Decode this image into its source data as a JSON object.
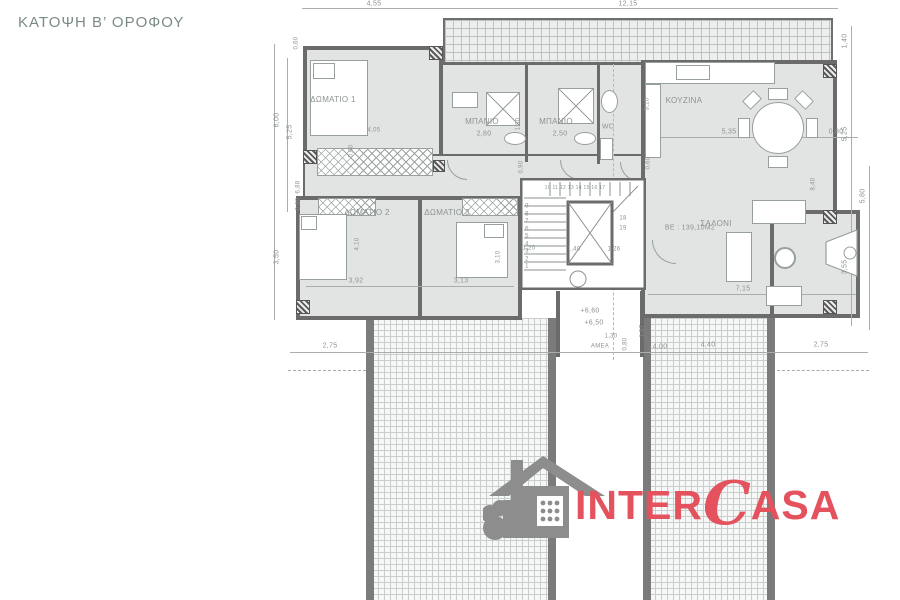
{
  "title": "ΚΑΤΟΨΗ Β’ ΟΡΟΦΟΥ",
  "logo": {
    "inter": "INTER",
    "c": "C",
    "asa": "ASA",
    "accent_color": "#e4525e",
    "house_color": "#8d8d8d"
  },
  "colors": {
    "wall": "#6b6b6b",
    "room_fill": "#e2e4e3",
    "dimension_text": "#8b9390",
    "title_text": "#7b8a84"
  },
  "plan": {
    "labels": [
      {
        "n": "room-label-bedroom1",
        "t": "ΔΩΜΑΤΙΟ 1",
        "x": 333,
        "y": 100,
        "s": 8
      },
      {
        "n": "room-label-bath1",
        "t": "ΜΠΑΝΙΟ",
        "x": 482,
        "y": 122,
        "s": 8
      },
      {
        "n": "room-label-bath2",
        "t": "ΜΠΑΝΙΟ",
        "x": 556,
        "y": 122,
        "s": 8
      },
      {
        "n": "room-label-wc",
        "t": "WC",
        "x": 608,
        "y": 128,
        "s": 7
      },
      {
        "n": "room-label-kitchen",
        "t": "ΚΟΥΖΙΝΑ",
        "x": 684,
        "y": 101,
        "s": 8
      },
      {
        "n": "room-label-living",
        "t": "ΣΑΛΟΝΙ",
        "x": 716,
        "y": 224,
        "s": 8
      },
      {
        "n": "room-label-bedroom2",
        "t": "ΔΩΜΑΤΙΟ 2",
        "x": 367,
        "y": 213,
        "s": 8
      },
      {
        "n": "room-label-bedroom3",
        "t": "ΔΩΜΑΤΙΟ 3",
        "x": 447,
        "y": 213,
        "s": 8
      },
      {
        "n": "area-label",
        "t": "ΒΕ : 139,10Μ2",
        "x": 690,
        "y": 229,
        "s": 7
      },
      {
        "n": "amea-label",
        "t": "ΑΜΕΑ",
        "x": 600,
        "y": 347,
        "s": 6
      },
      {
        "n": "dim-top-left",
        "t": "4,55",
        "x": 374,
        "y": 5,
        "s": 7
      },
      {
        "n": "dim-top-right",
        "t": "12,15",
        "x": 628,
        "y": 5,
        "s": 7
      },
      {
        "n": "dim-right-140",
        "t": "1,40",
        "x": 846,
        "y": 41,
        "s": 7,
        "r": -90
      },
      {
        "n": "dim-right-525",
        "t": "5,25",
        "x": 846,
        "y": 134,
        "s": 7,
        "r": -90
      },
      {
        "n": "dim-right-580",
        "t": "5,80",
        "x": 864,
        "y": 196,
        "s": 7,
        "r": -90
      },
      {
        "n": "dim-right-355",
        "t": "3,55",
        "x": 846,
        "y": 267,
        "s": 7,
        "r": -90
      },
      {
        "n": "dim-left-060",
        "t": "0,60",
        "x": 297,
        "y": 43,
        "s": 6,
        "r": -90
      },
      {
        "n": "dim-left-600",
        "t": "6,00",
        "x": 278,
        "y": 120,
        "s": 7,
        "r": -90
      },
      {
        "n": "dim-left-525",
        "t": "5,25",
        "x": 291,
        "y": 132,
        "s": 7,
        "r": -90
      },
      {
        "n": "dim-left-688",
        "t": "6,88",
        "x": 299,
        "y": 187,
        "s": 6,
        "r": -90
      },
      {
        "n": "dim-left-080",
        "t": "0,80",
        "x": 299,
        "y": 204,
        "s": 6,
        "r": -90
      },
      {
        "n": "dim-left-350",
        "t": "3,50",
        "x": 278,
        "y": 257,
        "s": 7,
        "r": -90
      },
      {
        "n": "dim-bottom-275-left",
        "t": "2,75",
        "x": 330,
        "y": 347,
        "s": 7
      },
      {
        "n": "dim-bottom-130",
        "t": "1,30",
        "x": 611,
        "y": 337,
        "s": 6
      },
      {
        "n": "dim-bottom-400",
        "t": "4,00",
        "x": 660,
        "y": 348,
        "s": 7
      },
      {
        "n": "dim-bottom-440",
        "t": "4,40",
        "x": 708,
        "y": 346,
        "s": 7
      },
      {
        "n": "dim-bottom-275-right",
        "t": "2,75",
        "x": 821,
        "y": 346,
        "s": 7
      },
      {
        "n": "dim-bedroom1-405",
        "t": "4,05",
        "x": 374,
        "y": 131,
        "s": 6
      },
      {
        "n": "dim-bath1-280",
        "t": "2,80",
        "x": 484,
        "y": 135,
        "s": 7
      },
      {
        "n": "dim-bath2-250",
        "t": "2,50",
        "x": 560,
        "y": 135,
        "s": 7
      },
      {
        "n": "dim-bath-180",
        "t": "1,80",
        "x": 519,
        "y": 124,
        "s": 6,
        "r": -90
      },
      {
        "n": "dim-bath-090",
        "t": "0,90",
        "x": 522,
        "y": 167,
        "s": 6,
        "r": -90
      },
      {
        "n": "dim-ward-060",
        "t": "0,60",
        "x": 352,
        "y": 151,
        "s": 6,
        "r": -90
      },
      {
        "n": "dim-kitchen-310",
        "t": "3,10",
        "x": 648,
        "y": 104,
        "s": 6,
        "r": -90
      },
      {
        "n": "dim-kitchen-060",
        "t": "0,60",
        "x": 649,
        "y": 163,
        "s": 6,
        "r": -90
      },
      {
        "n": "dim-living-535",
        "t": "5,35",
        "x": 729,
        "y": 133,
        "s": 7
      },
      {
        "n": "dim-living-080",
        "t": "0,80",
        "x": 836,
        "y": 133,
        "s": 7
      },
      {
        "n": "dim-living-840",
        "t": "8,40",
        "x": 814,
        "y": 184,
        "s": 6,
        "r": -90
      },
      {
        "n": "dim-living-715",
        "t": "7,15",
        "x": 743,
        "y": 290,
        "s": 7
      },
      {
        "n": "dim-bedroom2-392",
        "t": "3,92",
        "x": 356,
        "y": 282,
        "s": 7
      },
      {
        "n": "dim-bedroom2-410",
        "t": "4,10",
        "x": 358,
        "y": 244,
        "s": 6,
        "r": -90
      },
      {
        "n": "dim-bedroom3-313",
        "t": "3,13",
        "x": 461,
        "y": 282,
        "s": 7
      },
      {
        "n": "dim-bedroom3-310",
        "t": "3,10",
        "x": 499,
        "y": 257,
        "s": 6,
        "r": -90
      },
      {
        "n": "dim-stair-120",
        "t": "1,20",
        "x": 529,
        "y": 249,
        "s": 6
      },
      {
        "n": "dim-stair-140",
        "t": "1,40",
        "x": 574,
        "y": 250,
        "s": 6
      },
      {
        "n": "dim-stair-126",
        "t": "1,26",
        "x": 614,
        "y": 250,
        "s": 6
      },
      {
        "n": "level-660",
        "t": "+6,60",
        "x": 590,
        "y": 312,
        "s": 7
      },
      {
        "n": "level-650",
        "t": "+6,50",
        "x": 594,
        "y": 324,
        "s": 7
      },
      {
        "n": "dim-landing-157",
        "t": "1,57",
        "x": 643,
        "y": 331,
        "s": 6,
        "r": -90
      },
      {
        "n": "dim-amea-080",
        "t": "0,80",
        "x": 626,
        "y": 344,
        "s": 6,
        "r": -90
      },
      {
        "n": "stair-numbers-left",
        "t": "9\n8\n7\n6\n5\n4\n3\n2\n1",
        "x": 527,
        "y": 237,
        "s": 6
      },
      {
        "n": "stair-numbers-top",
        "t": "10 11 12 13 14 15 16 17",
        "x": 575,
        "y": 188,
        "s": 5
      },
      {
        "n": "stair-number-18",
        "t": "18",
        "x": 623,
        "y": 219,
        "s": 6
      },
      {
        "n": "stair-number-19",
        "t": "19",
        "x": 623,
        "y": 229,
        "s": 6
      }
    ]
  }
}
